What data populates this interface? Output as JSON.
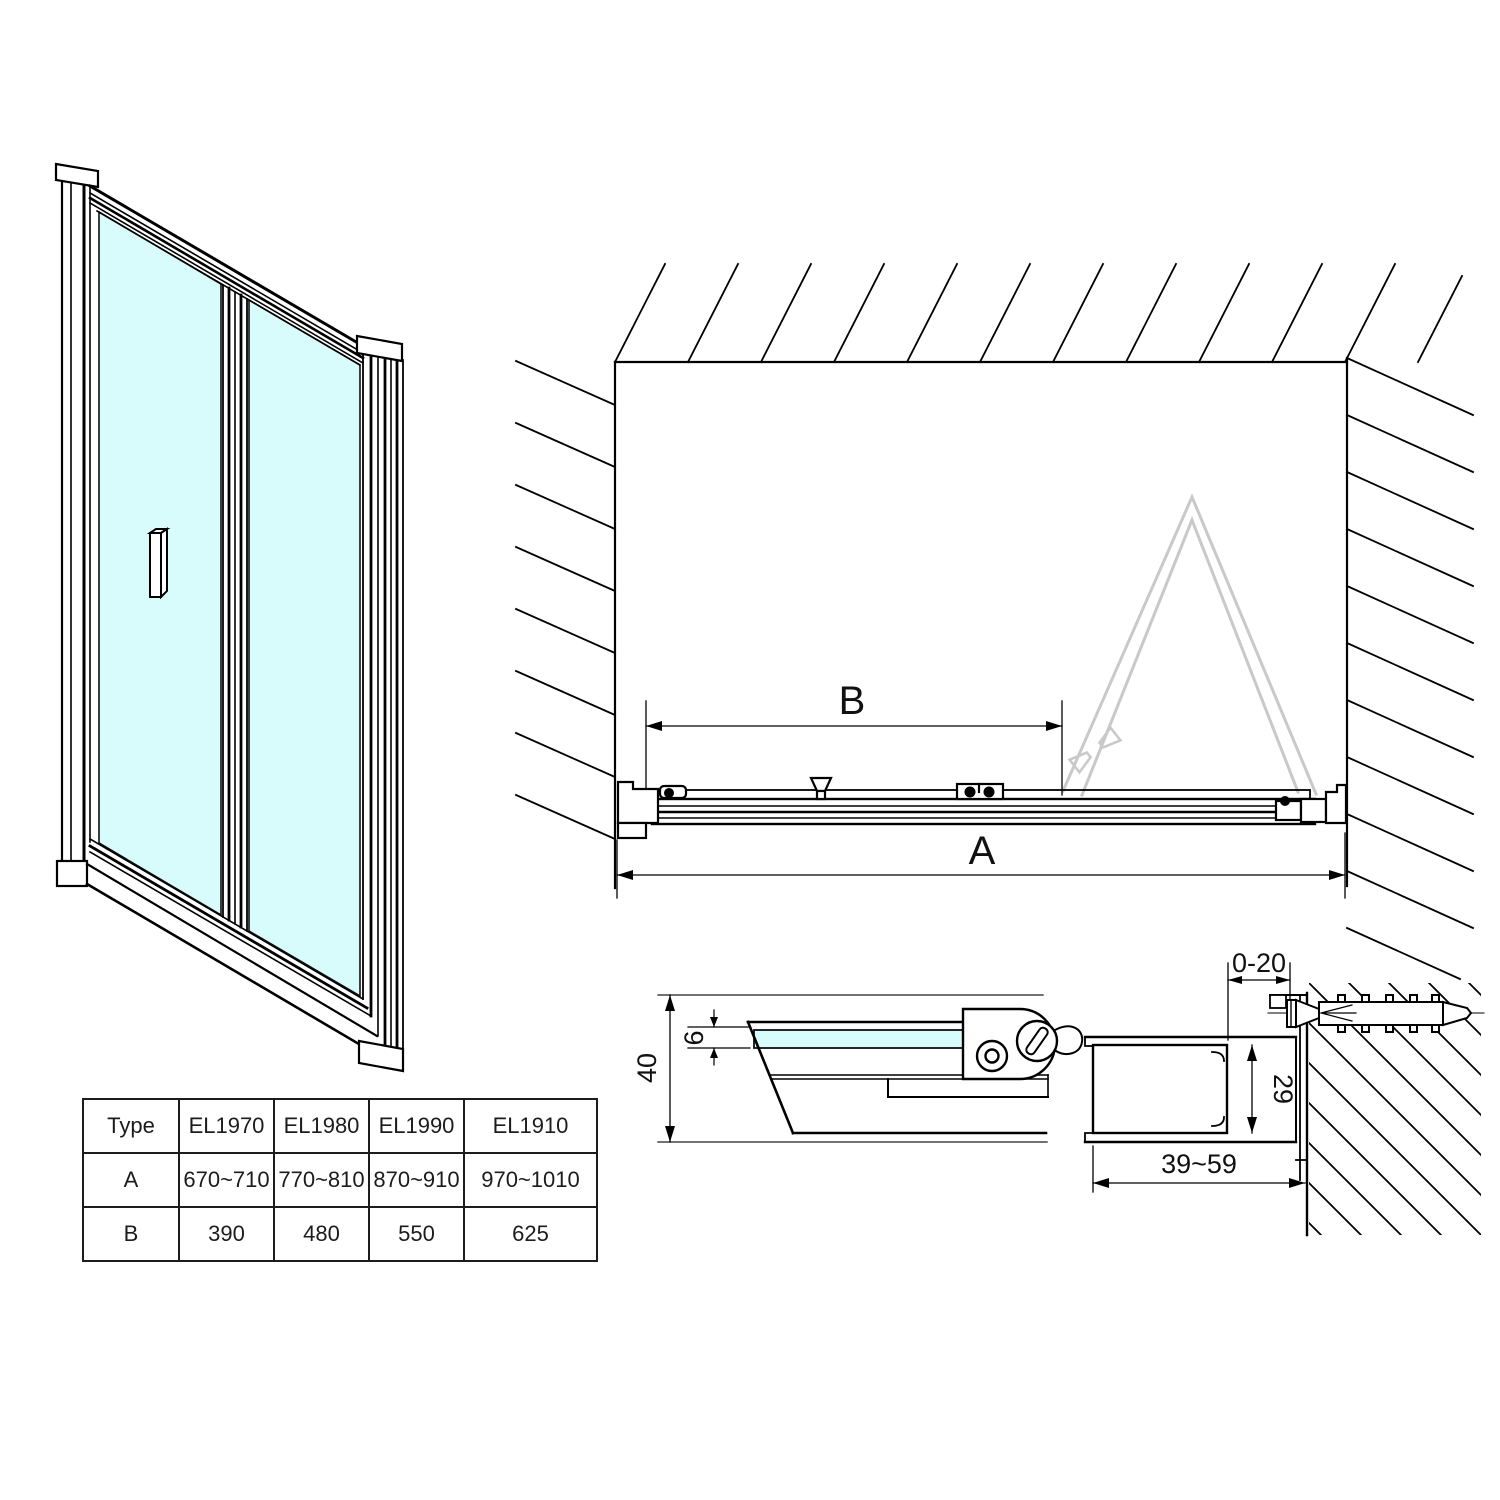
{
  "drawing": {
    "title": "Bi-fold shower door installation drawing",
    "labels": {
      "dim_a": "A",
      "dim_b": "B",
      "depth_40": "40",
      "glass_6": "6",
      "profile_29": "29",
      "gap_0_20": "0-20",
      "range_39_59": "39~59"
    }
  },
  "table": {
    "rows": [
      [
        "Type",
        "EL1970",
        "EL1980",
        "EL1990",
        "EL1910"
      ],
      [
        "A",
        "670~710",
        "770~810",
        "870~910",
        "970~1010"
      ],
      [
        "B",
        "390",
        "480",
        "550",
        "625"
      ]
    ]
  },
  "colors": {
    "glass": "#d8fbfb",
    "ghost_outline": "#c9c9c9",
    "line": "#000000",
    "background": "#ffffff"
  }
}
